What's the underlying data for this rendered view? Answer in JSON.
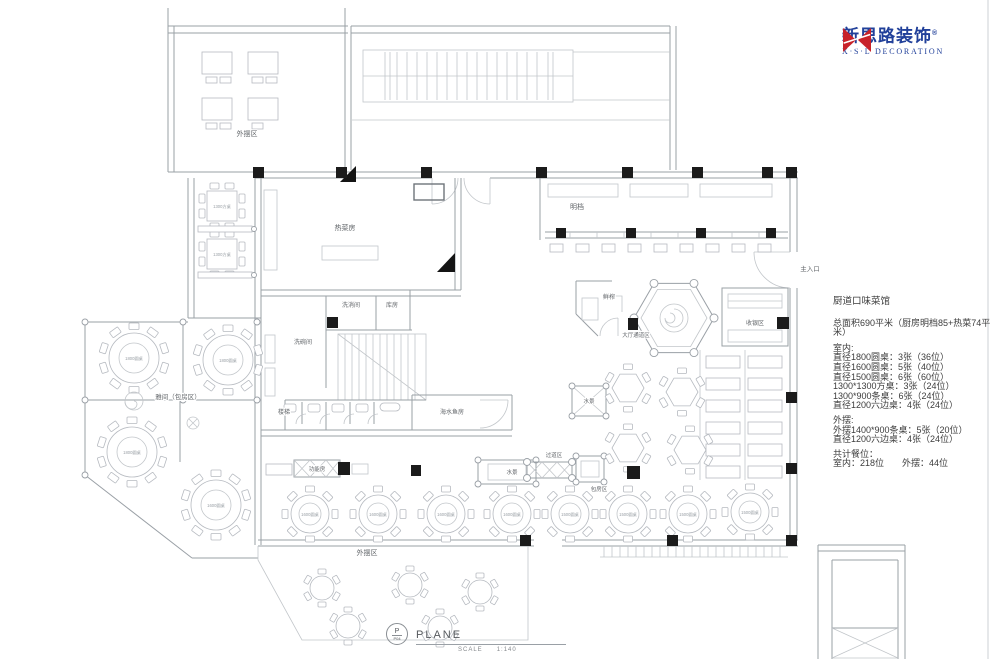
{
  "logo": {
    "icon_text": "X.S.L",
    "cn": "新思路装饰",
    "reg": "®",
    "en": "X·S·L DECORATION",
    "brand_red": "#c8222a",
    "brand_blue": "#21409a"
  },
  "panel": {
    "title": "厨道口味菜馆",
    "area_line": "总面积690平米（厨房明档85+热菜74平米）",
    "indoor_header": "室内:",
    "indoor_items": [
      "直径1800圆桌：3张（36位）",
      "直径1600圆桌：5张（40位）",
      "直径1500圆桌：6张（60位）",
      "1300*1300方桌：3张（24位）",
      "1300*900条桌：6张（24位）",
      "直径1200六边桌：4张（24位）"
    ],
    "outdoor_header": "外摆:",
    "outdoor_items": [
      "外摆1400*900条桌：5张（20位）",
      "直径1200六边桌：4张（24位）"
    ],
    "total_header": "共计餐位：",
    "total_line": "室内：218位　　外摆：44位"
  },
  "titleblock": {
    "bubble_top": "P",
    "bubble_bottom": "P04",
    "title": "PLANE",
    "scale_label": "SCALE",
    "scale_value": "1:140"
  },
  "plan": {
    "labels": {
      "outdoor_top": "外摆区",
      "hot_kitchen": "热菜房",
      "open_kitchen": "明档",
      "wash_disinfect": "洗消间",
      "storage": "库房",
      "dishwash": "洗碗间",
      "stairs": "楼梯",
      "seafood_room": "海水鱼房",
      "private_rooms": "雅间（包房区）",
      "juice_bar": "鲜榨",
      "hall_corridor": "大厅通道区",
      "cashier": "收银区",
      "main_entrance": "主入口",
      "water_feature_1": "水景",
      "water_feature_2": "水景",
      "function_room": "功能房",
      "walkway": "过道区",
      "private_zone": "包房区",
      "outdoor_bottom": "外摆区"
    },
    "table_types": {
      "t1800": "1800圆桌",
      "t1600": "1600圆桌",
      "t1500": "1500圆桌",
      "t1300": "1300方桌"
    }
  }
}
